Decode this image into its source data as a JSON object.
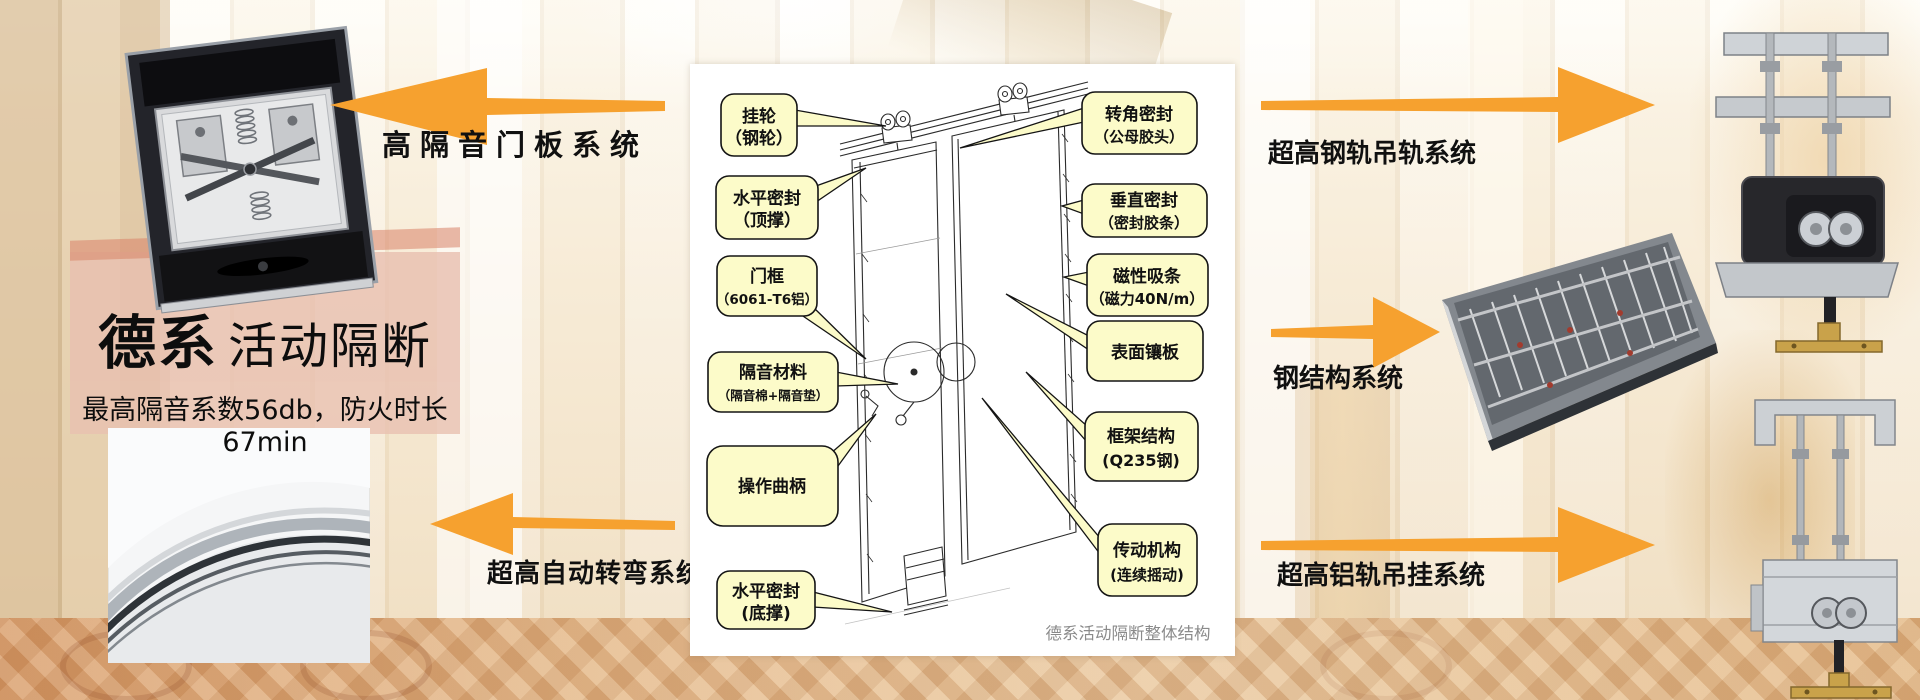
{
  "headline": {
    "brand": "德系",
    "product": "活动隔断",
    "subtitle": "最高隔音系数56db，防火时长67min"
  },
  "systems": {
    "door_panel": "高隔音门板系统",
    "auto_turn": "超高自动转弯系统",
    "steel_rail": "超高钢轨吊轨系统",
    "steel_structure": "钢结构系统",
    "alu_rail": "超高铝轨吊挂系统"
  },
  "diagram": {
    "caption": "德系活动隔断整体结构",
    "callouts": {
      "left": [
        {
          "line1": "挂轮",
          "line2": "（钢轮）"
        },
        {
          "line1": "水平密封",
          "line2": "（顶撑）"
        },
        {
          "line1": "门框",
          "line2": "（6061-T6铝）"
        },
        {
          "line1": "隔音材料",
          "line2": "（隔音棉+隔音垫）"
        },
        {
          "line1": "操作曲柄",
          "line2": ""
        },
        {
          "line1": "水平密封",
          "line2": "(底撑)"
        }
      ],
      "right": [
        {
          "line1": "转角密封",
          "line2": "（公母胶头）"
        },
        {
          "line1": "垂直密封",
          "line2": "（密封胶条）"
        },
        {
          "line1": "磁性吸条",
          "line2": "（磁力40N/m）"
        },
        {
          "line1": "表面镶板",
          "line2": ""
        },
        {
          "line1": "框架结构",
          "line2": "(Q235钢)"
        },
        {
          "line1": "传动机构",
          "line2": "(连续摇动)"
        }
      ]
    }
  },
  "colors": {
    "arrow": "#F6A12F",
    "callout_fill": "#FCFBC9",
    "callout_border": "#141414",
    "panel_background": "#FFFFFF",
    "caption_text": "#8A8A8A"
  }
}
